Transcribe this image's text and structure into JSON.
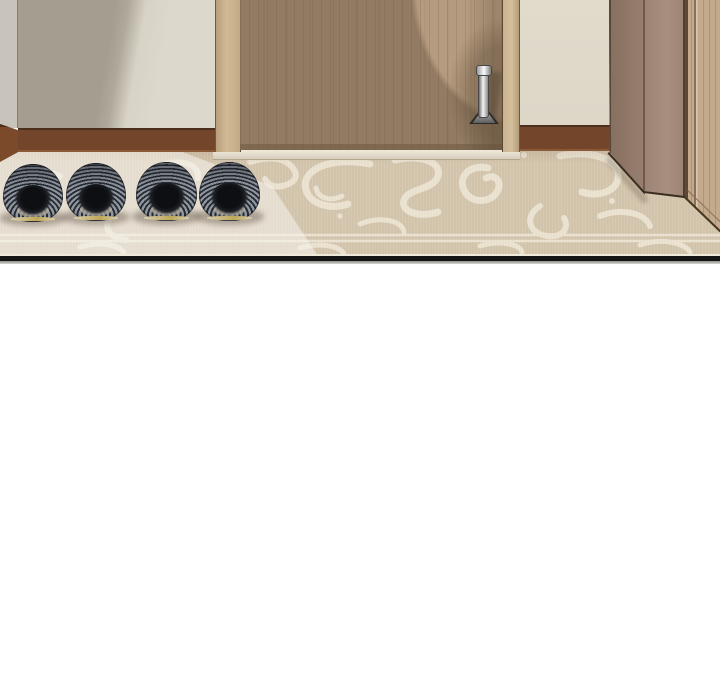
{
  "scene": {
    "description": "Webtoon panel: apartment entryway with closed wooden front door, swirl-patterned beige rug, and two pairs of striped gray slippers lined up by the step",
    "panel": {
      "label": "comic-panel",
      "border_color": "#161616"
    },
    "objects": [
      {
        "label": "left wall in shadow"
      },
      {
        "label": "front door of light wood"
      },
      {
        "label": "metal lever door handle"
      },
      {
        "label": "door frame"
      },
      {
        "label": "brown baseboard"
      },
      {
        "label": "patterned entry rug"
      },
      {
        "label": "sunlight beam on rug"
      },
      {
        "label": "pair of gray knit slippers (left)"
      },
      {
        "label": "pair of gray knit slippers (right)"
      },
      {
        "label": "dark taupe shoe cabinet"
      },
      {
        "label": "wooden side cabinet panel"
      },
      {
        "label": "door threshold strip"
      }
    ],
    "slippers": {
      "count": 4,
      "arrangement": "two pairs, heels facing viewer"
    },
    "palette": {
      "wall_shadow": "#a49d90",
      "wall_light": "#ddd8cc",
      "side_wall": "#c9c4bb",
      "baseboard": "#73452a",
      "baseboard_edge": "#4b2e1b",
      "door_wood": "#b59c80",
      "door_grain": "#a08a6d",
      "door_frame_wood": "#c9b290",
      "right_wall": "#e0d8c9",
      "threshold": "#e6dfd0",
      "carpet_base": "#d2c3ab",
      "carpet_motif": "#ebe3d2",
      "carpet_lit": "#f7f5ef",
      "cabinet_side": "#8d7666",
      "cabinet_front": "#a1887a",
      "side_panel_wood": "#c3aa8c",
      "slipper_dark": "#262a31",
      "slipper_light": "#8f969f",
      "slipper_opening": "#0d0f12",
      "slipper_sole": "#c0a855",
      "handle_metal": "#d8d8d8",
      "panel_border": "#161616",
      "page_background": "#ffffff"
    }
  }
}
